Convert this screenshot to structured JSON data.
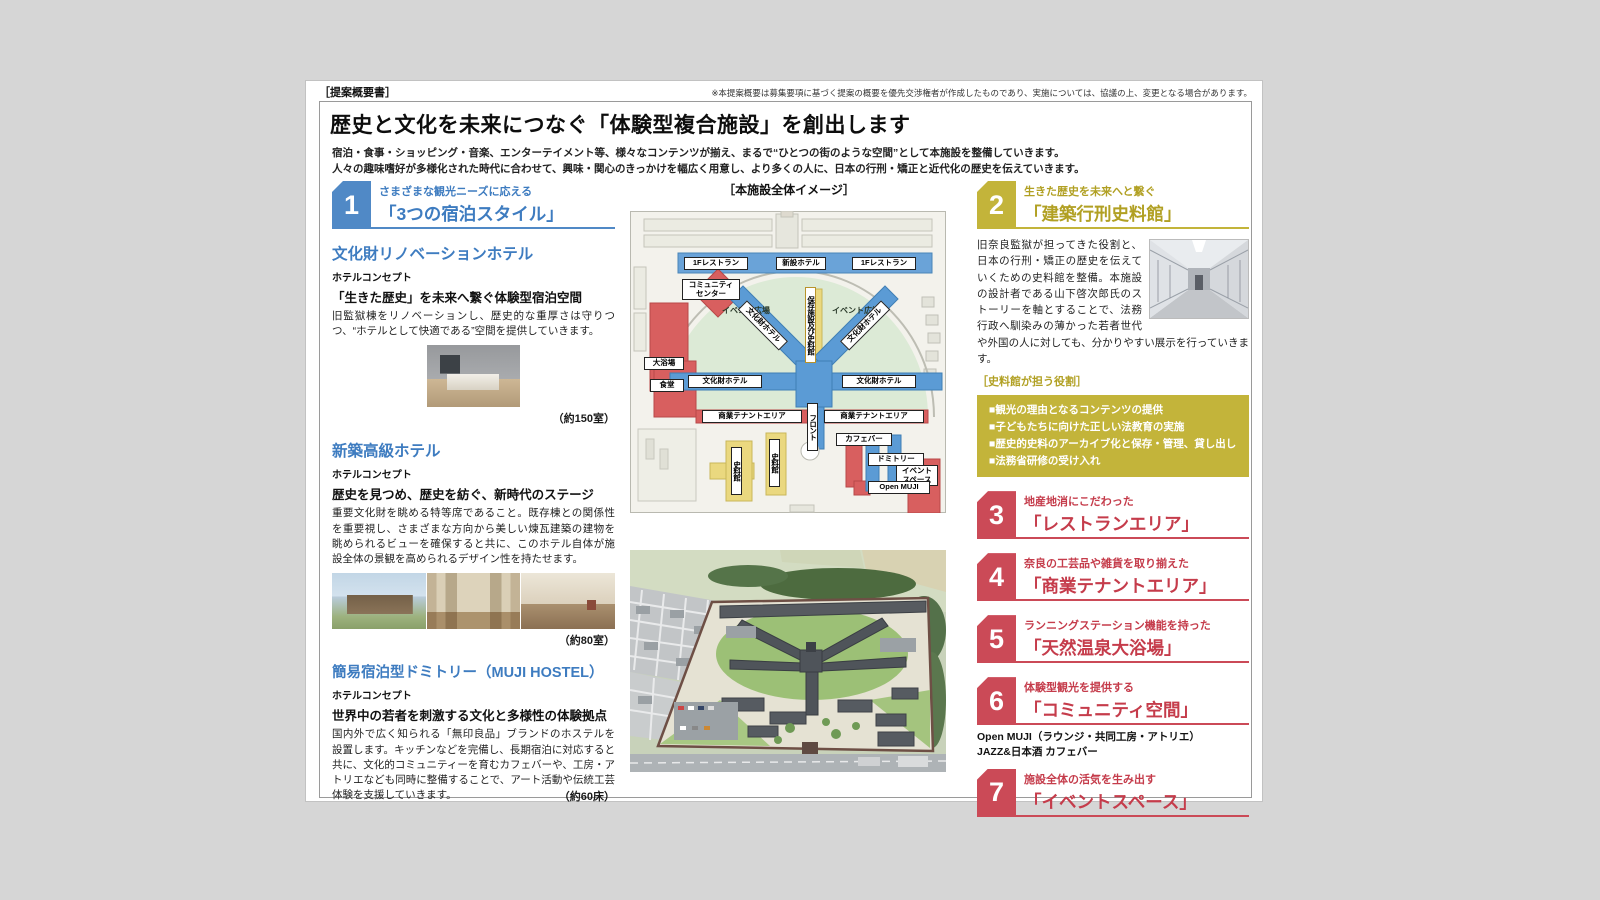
{
  "header": {
    "doc_label": "［提案概要書］",
    "disclaimer": "※本提案概要は募集要項に基づく提案の概要を優先交渉権者が作成したものであり、実施については、協議の上、変更となる場合があります。",
    "title": "歴史と文化を未来につなぐ「体験型複合施設」を創出します",
    "subtitle1": "宿泊・食事・ショッピング・音楽、エンターテイメント等、様々なコンテンツが揃え、まるで“ひとつの街のような空間”として本施設を整備していきます。",
    "subtitle2": "人々の趣味嗜好が多様化された時代に合わせて、興味・関心のきっかけを幅広く用意し、より多くの人に、日本の行刑・矯正と近代化の歴史を伝えていきます。"
  },
  "section1": {
    "number": "1",
    "tagline": "さまざまな観光ニーズに応える",
    "title": "「3つの宿泊スタイル」",
    "hotels": [
      {
        "name": "文化財リノベーションホテル",
        "concept_label": "ホテルコンセプト",
        "concept": "「生きた歴史」を未来へ繋ぐ体験型宿泊空間",
        "body": "旧監獄棟をリノベーションし、歴史的な重厚さは守りつつ、“ホテルとして快適である”空間を提供していきます。",
        "capacity": "（約150室）"
      },
      {
        "name": "新築高級ホテル",
        "concept_label": "ホテルコンセプト",
        "concept": "歴史を見つめ、歴史を紡ぐ、新時代のステージ",
        "body": "重要文化財を眺める特等席であること。既存棟との関係性を重要視し、さまざまな方向から美しい煉瓦建築の建物を眺められるビューを確保すると共に、このホテル自体が施設全体の景観を高められるデザイン性を持たせます。",
        "capacity": "（約80室）"
      },
      {
        "name": "簡易宿泊型ドミトリー（MUJI HOSTEL）",
        "concept_label": "ホテルコンセプト",
        "concept": "世界中の若者を刺激する文化と多様性の体験拠点",
        "body": "国内外で広く知られる「無印良品」ブランドのホステルを設置します。キッチンなどを完備し、長期宿泊に対応すると共に、文化的コミュニティーを育むカフェバーや、工房・アトリエなども同時に整備することで、アート活動や伝統工芸体験を支援していきます。",
        "capacity": "（約60床）"
      }
    ]
  },
  "center": {
    "map_title": "［本施設全体イメージ］",
    "map_labels": {
      "rest_left": "1Fレストラン",
      "new_hotel": "新設ホテル",
      "rest_right": "1Fレストラン",
      "community_center": "コミュニティ センター",
      "bath": "大浴場",
      "event_plaza_left": "イベント広場",
      "event_plaza_right": "イベント広場",
      "preservation": "保存施設及び史料館",
      "heritage_diag_left": "文化財ホテル",
      "heritage_diag_right": "文化財ホテル",
      "heritage_left": "文化財ホテル",
      "heritage_right": "文化財ホテル",
      "front": "フロント",
      "dining": "食堂",
      "commercial_left": "商業テナントエリア",
      "commercial_right": "商業テナントエリア",
      "museum_a": "史料館",
      "museum_b": "史料館",
      "cafe_bar": "カフェバー",
      "dormitory": "ドミトリー",
      "event_space": "イベント スペース",
      "open_muji": "Open MUJI"
    }
  },
  "section2": {
    "number": "2",
    "tagline": "生きた歴史を未来へと繋ぐ",
    "title": "「建築行刑史料館」",
    "body": "旧奈良監獄が担ってきた役割と、日本の行刑・矯正の歴史を伝えていくための史料館を整備。本施設の設計者である山下啓次郎氏のストーリーを軸とすることで、法務行政へ馴染みの薄かった若者世代や外国の人に対しても、分かりやすい展示を行っていきます。",
    "roles_title": "［史料館が担う役割］",
    "roles": [
      "■観光の理由となるコンテンツの提供",
      "■子どもたちに向けた正しい法教育の実施",
      "■歴史的史料のアーカイブ化と保存・管理、貸し出し",
      "■法務省研修の受け入れ"
    ]
  },
  "sections": [
    {
      "number": "3",
      "tagline": "地産地消にこだわった",
      "title": "「レストランエリア」"
    },
    {
      "number": "4",
      "tagline": "奈良の工芸品や雑貨を取り揃えた",
      "title": "「商業テナントエリア」"
    },
    {
      "number": "5",
      "tagline": "ランニングステーション機能を持った",
      "title": "「天然温泉大浴場」"
    },
    {
      "number": "6",
      "tagline": "体験型観光を提供する",
      "title": "「コミュニティ空間」",
      "notes": [
        "Open MUJI（ラウンジ・共同工房・アトリエ）",
        "JAZZ&日本酒 カフェバー"
      ]
    },
    {
      "number": "7",
      "tagline": "施設全体の活気を生み出す",
      "title": "「イベントスペース」"
    }
  ],
  "colors": {
    "blue": "#5089c6",
    "gold": "#c3b43a",
    "red": "#cb4a57"
  }
}
